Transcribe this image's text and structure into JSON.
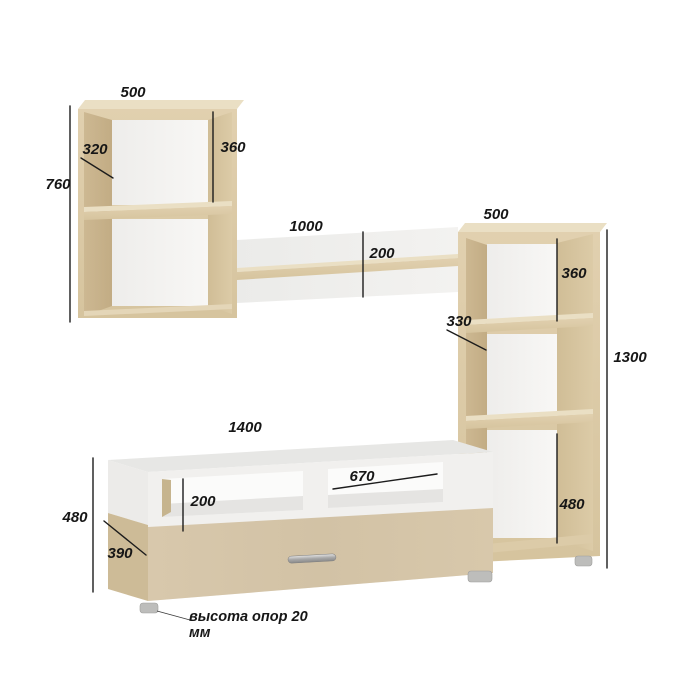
{
  "dimensions": {
    "wall_cabinet": {
      "width_mm": "500",
      "depth_mm": "320",
      "height_mm": "760",
      "opening_mm": "360"
    },
    "wall_shelf": {
      "length_mm": "1000",
      "height_mm": "200"
    },
    "tall_unit": {
      "width_mm": "500",
      "depth_mm": "330",
      "height_mm": "1300",
      "top_opening_mm": "360",
      "bottom_opening_mm": "480"
    },
    "tv_stand": {
      "length_mm": "1400",
      "depth_mm": "390",
      "height_mm": "480",
      "niche_height_mm": "200",
      "niche_width_mm": "670"
    }
  },
  "note": {
    "line1": "высота опор 20",
    "line2": "мм"
  },
  "colors": {
    "wood_front": "#dccaa6",
    "wood_side": "#c9b48e",
    "wood_inner": "#d4c29c",
    "wood_top": "#eadfc4",
    "wood_drawer": "#d5c5a9",
    "carcass_white": "#f1f0ee",
    "back_white": "#f7f6f4",
    "dimension_line": "#1c1c1c"
  }
}
